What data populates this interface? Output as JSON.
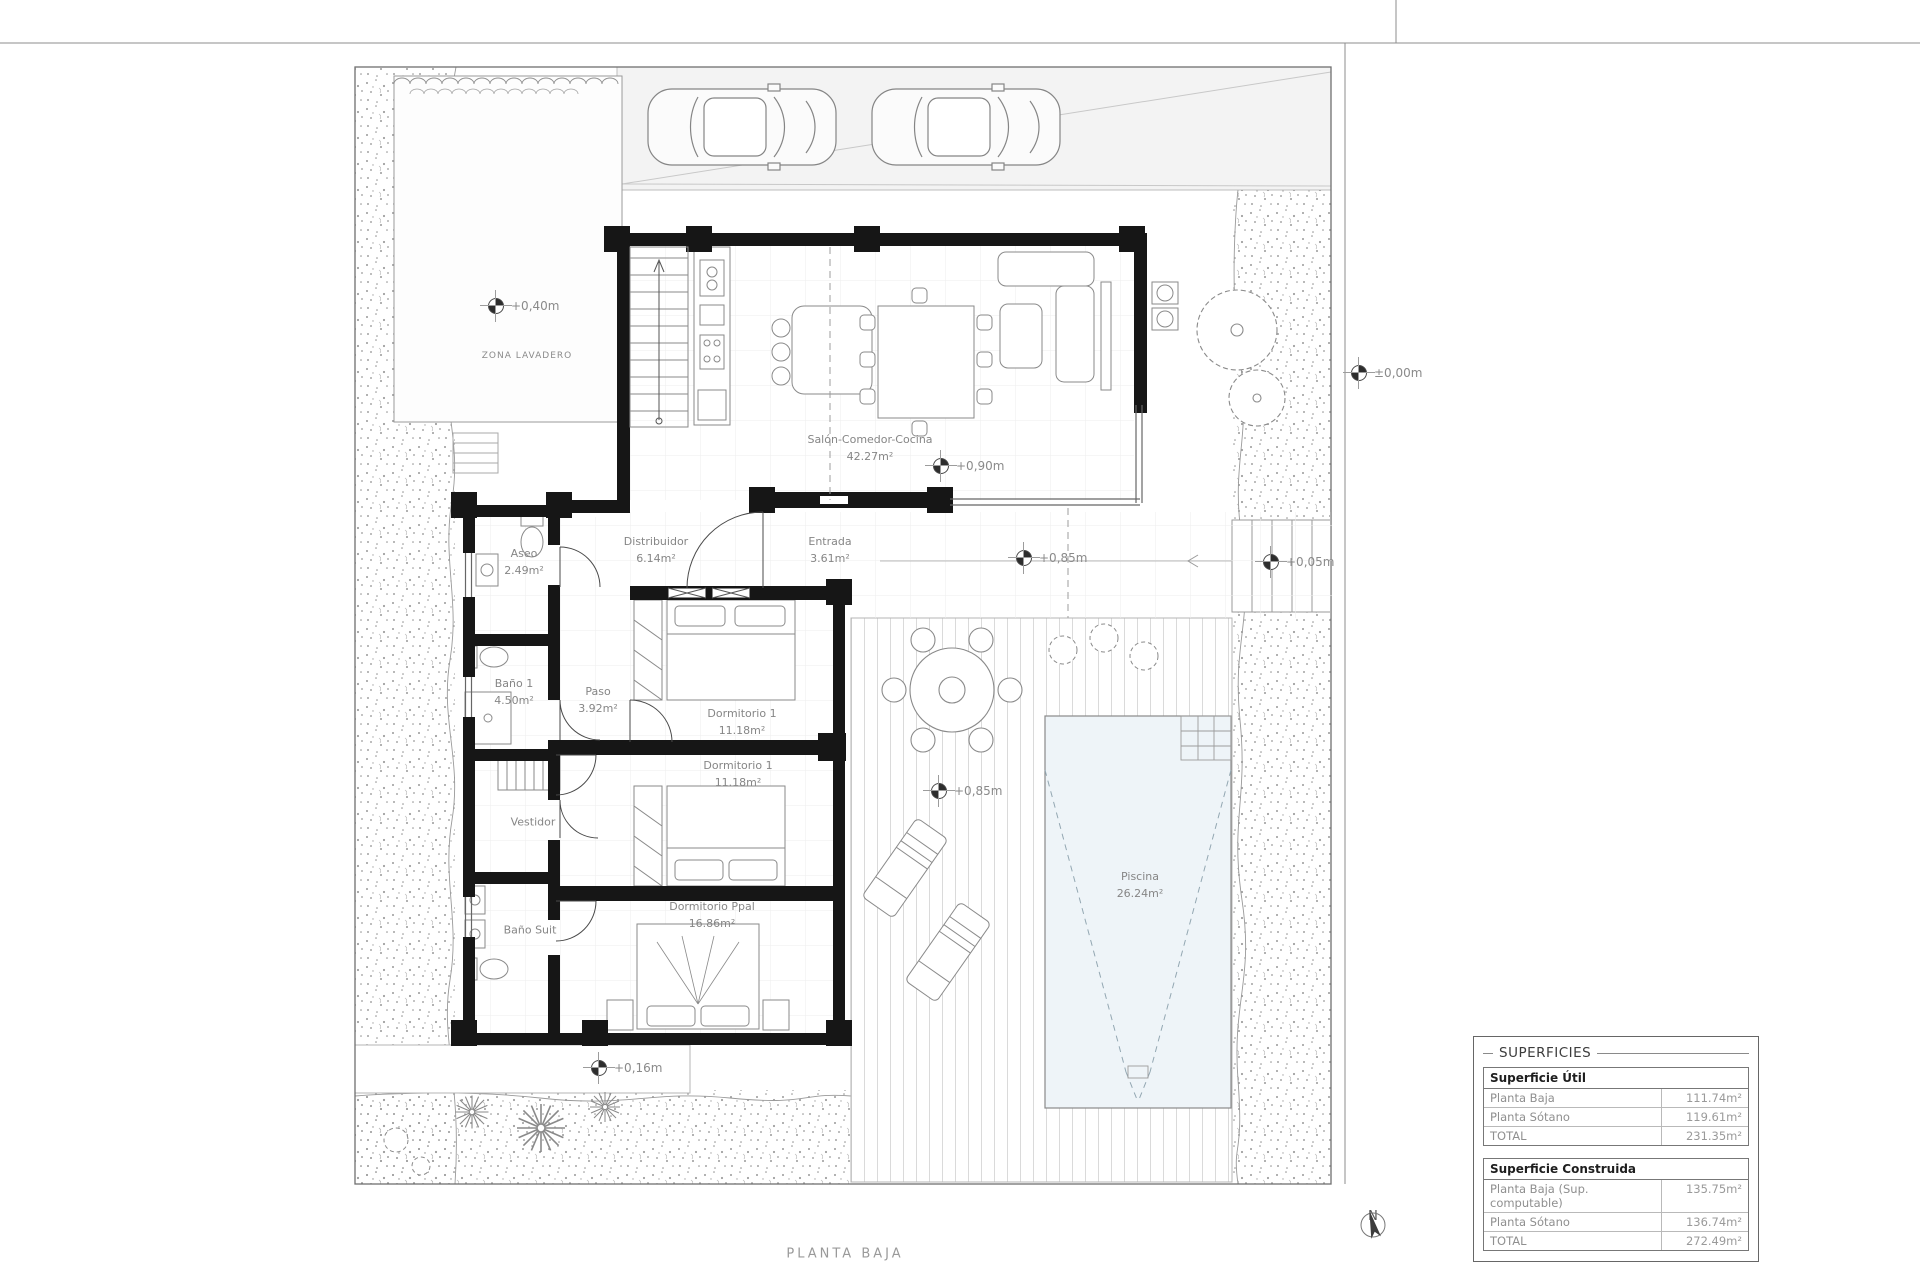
{
  "plan": {
    "title": "PLANTA BAJA",
    "north_label": "N",
    "zone_label": "ZONA LAVADERO",
    "rooms": [
      {
        "name": "Salón-Comedor-Cocina",
        "area": "42.27m²"
      },
      {
        "name": "Distribuidor",
        "area": "6.14m²"
      },
      {
        "name": "Entrada",
        "area": "3.61m²"
      },
      {
        "name": "Aseo",
        "area": "2.49m²"
      },
      {
        "name": "Baño 1",
        "area": "4.50m²"
      },
      {
        "name": "Paso",
        "area": "3.92m²"
      },
      {
        "name": "Dormitorio 1",
        "area": "11.18m²"
      },
      {
        "name": "Dormitorio 1",
        "area": "11.18m²"
      },
      {
        "name": "Vestidor",
        "area": ""
      },
      {
        "name": "Baño Suit",
        "area": ""
      },
      {
        "name": "Dormitorio Ppal",
        "area": "16.86m²"
      },
      {
        "name": "Piscina",
        "area": "26.24m²"
      }
    ],
    "levels": [
      {
        "label": "+0,40m"
      },
      {
        "label": "±0,00m"
      },
      {
        "label": "+0,90m"
      },
      {
        "label": "+0,85m"
      },
      {
        "label": "+0,05m"
      },
      {
        "label": "+0,85m"
      },
      {
        "label": "+0,16m"
      }
    ]
  },
  "superficies": {
    "title": "SUPERFICIES",
    "util": {
      "header": "Superficie Útil",
      "rows": [
        {
          "label": "Planta Baja",
          "value": "111.74m²"
        },
        {
          "label": "Planta Sótano",
          "value": "119.61m²"
        },
        {
          "label": "TOTAL",
          "value": "231.35m²"
        }
      ]
    },
    "construida": {
      "header": "Superficie Construida",
      "rows": [
        {
          "label": "Planta Baja (Sup. computable)",
          "value": "135.75m²"
        },
        {
          "label": "Planta Sótano",
          "value": "136.74m²"
        },
        {
          "label": "TOTAL",
          "value": "272.49m²"
        }
      ]
    }
  },
  "colors": {
    "wall": "#161616",
    "pool_fill": "#eef4f8",
    "label_text": "#868686"
  }
}
